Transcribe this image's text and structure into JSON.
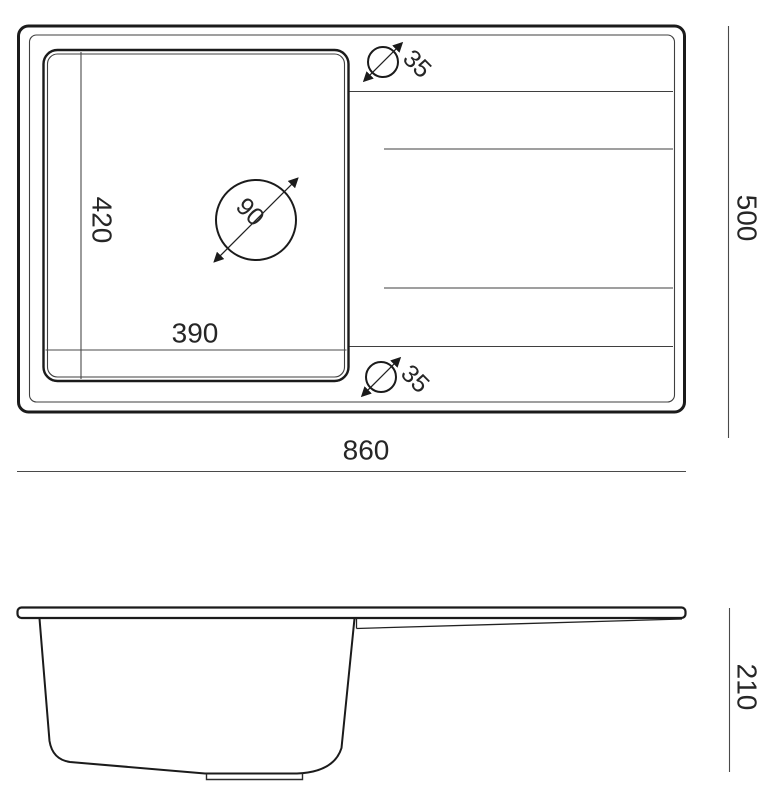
{
  "drawing": {
    "kind": "sink-technical-drawing",
    "views": {
      "top": {
        "name": "top-view",
        "labels": {
          "basin_depth": "420",
          "basin_width": "390",
          "drain_diameter": "90",
          "tap_hole_top_diameter": "35",
          "tap_hole_bottom_diameter": "35",
          "overall_width": "860",
          "overall_depth": "500"
        }
      },
      "side": {
        "name": "side-view",
        "labels": {
          "overall_height": "210"
        }
      }
    },
    "colors": {
      "background": "#ffffff",
      "main_line": "#1b1b1b",
      "thin_line": "#3f3f3f",
      "dimension_line": "#4a4a4a",
      "text": "#262626"
    }
  }
}
